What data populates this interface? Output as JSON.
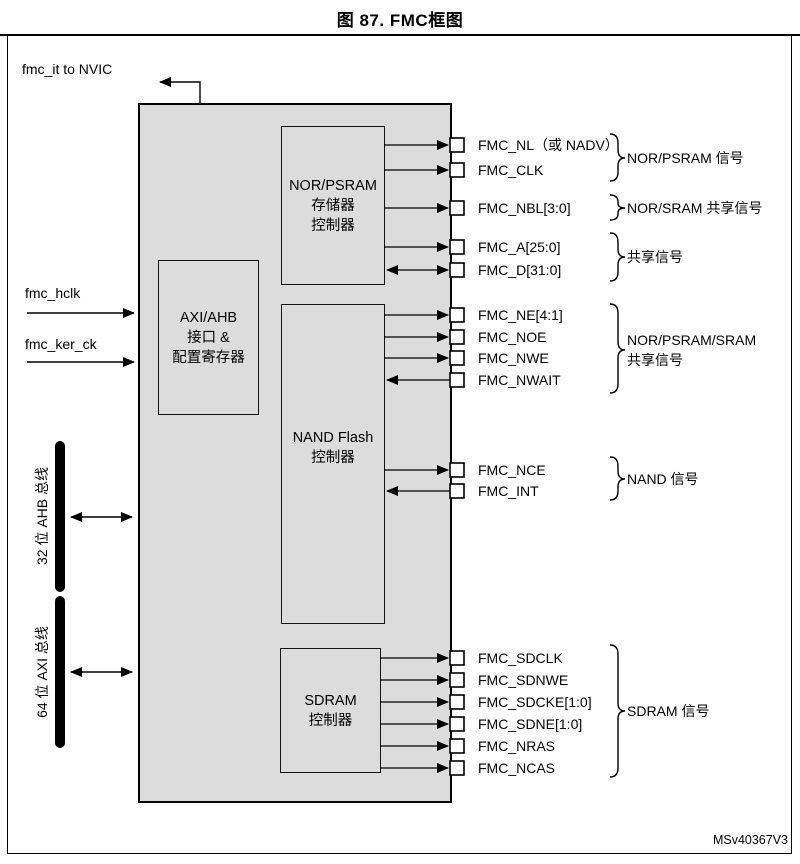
{
  "figure": {
    "title": "图 87. FMC框图",
    "code": "MSv40367V3"
  },
  "interrupt": {
    "label": "fmc_it to NVIC"
  },
  "clocks": [
    {
      "label": "fmc_hclk"
    },
    {
      "label": "fmc_ker_ck"
    }
  ],
  "buses": [
    {
      "label": "32 位 AHB 总线",
      "width_bits": 32
    },
    {
      "label": "64 位 AXI 总线",
      "width_bits": 64
    }
  ],
  "blocks": {
    "interface": {
      "label": "AXI/AHB\n接口 &\n配置寄存器"
    },
    "nor_psram": {
      "label": "NOR/PSRAM\n存储器\n控制器"
    },
    "nand": {
      "label": "NAND Flash\n控制器"
    },
    "sdram": {
      "label": "SDRAM\n控制器"
    }
  },
  "signals": [
    {
      "name": "FMC_NL（或 NADV）",
      "direction": "out"
    },
    {
      "name": "FMC_CLK",
      "direction": "out"
    },
    {
      "name": "FMC_NBL[3:0]",
      "direction": "out"
    },
    {
      "name": "FMC_A[25:0]",
      "direction": "out"
    },
    {
      "name": "FMC_D[31:0]",
      "direction": "bidirectional"
    },
    {
      "name": "FMC_NE[4:1]",
      "direction": "out"
    },
    {
      "name": "FMC_NOE",
      "direction": "out"
    },
    {
      "name": "FMC_NWE",
      "direction": "out"
    },
    {
      "name": "FMC_NWAIT",
      "direction": "in"
    },
    {
      "name": "FMC_NCE",
      "direction": "out"
    },
    {
      "name": "FMC_INT",
      "direction": "in"
    },
    {
      "name": "FMC_SDCLK",
      "direction": "out"
    },
    {
      "name": "FMC_SDNWE",
      "direction": "out"
    },
    {
      "name": "FMC_SDCKE[1:0]",
      "direction": "out"
    },
    {
      "name": "FMC_SDNE[1:0]",
      "direction": "out"
    },
    {
      "name": "FMC_NRAS",
      "direction": "out"
    },
    {
      "name": "FMC_NCAS",
      "direction": "out"
    }
  ],
  "signal_groups": [
    {
      "label": "NOR/PSRAM 信号"
    },
    {
      "label": "NOR/SRAM 共享信号"
    },
    {
      "label": "共享信号"
    },
    {
      "label": "NOR/PSRAM/SRAM\n共享信号"
    },
    {
      "label": "NAND 信号"
    },
    {
      "label": "SDRAM 信号"
    }
  ]
}
